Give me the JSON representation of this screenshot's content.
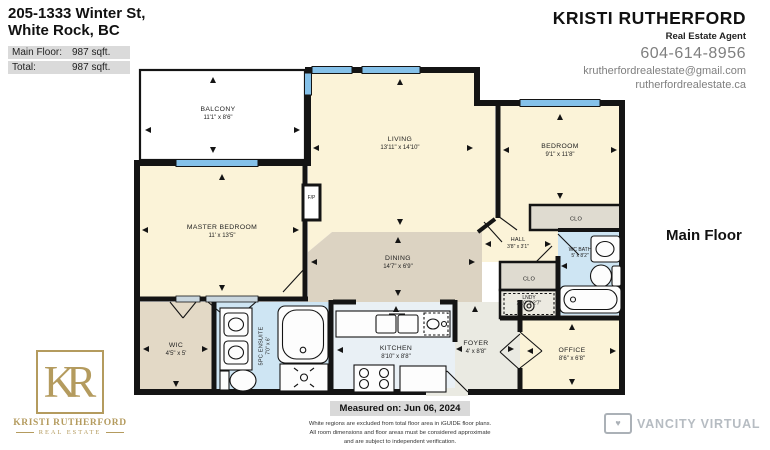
{
  "header": {
    "address_line1": "205-1333 Winter St,",
    "address_line2": "White Rock, BC",
    "area_rows": [
      {
        "label": "Main Floor:",
        "value": "987 sqft."
      },
      {
        "label": "Total:",
        "value": "987 sqft."
      }
    ]
  },
  "agent": {
    "name": "KRISTI RUTHERFORD",
    "title": "Real Estate Agent",
    "phone": "604-614-8956",
    "email": "krutherfordrealestate@gmail.com",
    "website": "rutherfordrealestate.ca"
  },
  "floor_label": "Main Floor",
  "rooms": {
    "balcony": {
      "name": "BALCONY",
      "dims": "11'1\" x 8'6\""
    },
    "living": {
      "name": "LIVING",
      "dims": "13'11\" x 14'10\""
    },
    "bedroom": {
      "name": "BEDROOM",
      "dims": "9'1\" x 11'8\""
    },
    "bedroom_closet": {
      "name": "CLO"
    },
    "master_bedroom": {
      "name": "MASTER BEDROOM",
      "dims": "11' x 13'5\""
    },
    "fireplace": {
      "name": "F/P"
    },
    "dining": {
      "name": "DINING",
      "dims": "14'7\" x 6'9\""
    },
    "hall": {
      "name": "HALL",
      "dims": "3'8\" x 3'1\""
    },
    "hall_closet": {
      "name": "CLO"
    },
    "laundry": {
      "name": "LNDY",
      "dims": "2'10\" x 2'7\""
    },
    "wc_bath": {
      "name": "WC BATH",
      "dims": "5' x 8'2\""
    },
    "wic": {
      "name": "WIC",
      "dims": "4'5\" x 5'"
    },
    "ensuite": {
      "name": "5PC ENSUITE",
      "dims": "7'0\" x 6'"
    },
    "kitchen": {
      "name": "KITCHEN",
      "dims": "8'10\" x 8'8\""
    },
    "foyer": {
      "name": "FOYER",
      "dims": "4' x 8'8\""
    },
    "office": {
      "name": "OFFICE",
      "dims": "8'6\" x 6'8\""
    }
  },
  "footer": {
    "measured_on": "Measured on: Jun 06, 2024",
    "disclaimer_line1": "White regions are excluded from total floor area in iGUIDE floor plans.",
    "disclaimer_line2": "All room dimensions and floor areas must be considered approximate",
    "disclaimer_line3": "and are subject to independent verification."
  },
  "logos": {
    "kr_monogram": "KR",
    "kr_name": "KRISTI RUTHERFORD",
    "kr_subtitle": "REAL ESTATE",
    "vancity_text": "VANCITY VIRTUAL",
    "vancity_icon": "camera-heart-icon"
  },
  "colors": {
    "room_cream": "#FBF3D8",
    "dining_tan": "#DCD3C2",
    "wic_tan": "#E3D9C6",
    "bath_blue": "#CEE5F3",
    "kitchen_blue": "#E9F0F5",
    "foyer_gray": "#EAEAE2",
    "closet_gray": "#DFDBD0",
    "window_blue": "#85C1E9",
    "wall_black": "#141414",
    "logo_gold": "#B49B5E",
    "header_row_gray": "#DADADA"
  }
}
